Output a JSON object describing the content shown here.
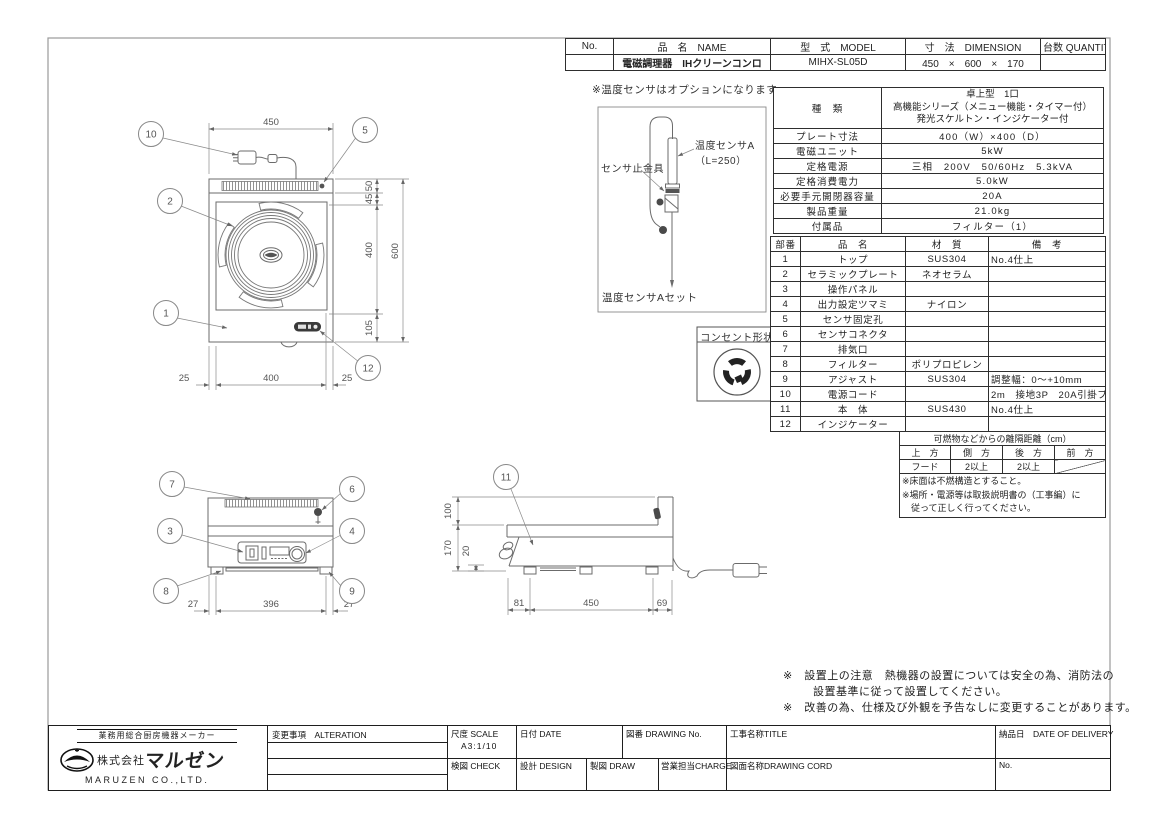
{
  "colors": {
    "line": "#6b6b6b",
    "dim_text": "#555555",
    "table_border": "#2e2e2e",
    "fill_dark": "#3a3a3a"
  },
  "top_table": {
    "headers": {
      "no": "No.",
      "name": "品　名　NAME",
      "model": "型　式　MODEL",
      "dimension": "寸　法　DIMENSION",
      "quantity": "台数 QUANTITY"
    },
    "row": {
      "no": "",
      "name": "電磁調理器　IHクリーンコンロ",
      "model": "MIHX-SL05D",
      "dimension": "450　×　600　×　170",
      "quantity": ""
    }
  },
  "sensor": {
    "note": "※温度センサはオプションになります。",
    "label_a": "温度センサA",
    "label_a_len": "（L=250）",
    "label_clamp": "センサ止金具",
    "caption": "温度センサAセット"
  },
  "outlet": {
    "title": "コンセント形状"
  },
  "spec_table": {
    "kind": {
      "label": "種　類",
      "lines": [
        "卓上型　1口",
        "高機能シリーズ（メニュー機能・タイマー付）",
        "発光スケルトン・インジケーター付"
      ]
    },
    "rows": [
      {
        "label": "プレート寸法",
        "value": "400（W）×400（D）"
      },
      {
        "label": "電磁ユニット",
        "value": "5kW"
      },
      {
        "label": "定格電源",
        "value": "三相　200V　50/60Hz　5.3kVA"
      },
      {
        "label": "定格消費電力",
        "value": "5.0kW"
      },
      {
        "label": "必要手元開閉器容量",
        "value": "20A"
      },
      {
        "label": "製品重量",
        "value": "21.0kg"
      },
      {
        "label": "付属品",
        "value": "フィルター（1）"
      }
    ]
  },
  "parts_table": {
    "headers": [
      "部番",
      "品　名",
      "材　質",
      "備　考"
    ],
    "rows": [
      {
        "no": "1",
        "name": "トップ",
        "material": "SUS304",
        "note": "No.4仕上"
      },
      {
        "no": "2",
        "name": "セラミックプレート",
        "material": "ネオセラム",
        "note": ""
      },
      {
        "no": "3",
        "name": "操作パネル",
        "material": "",
        "note": ""
      },
      {
        "no": "4",
        "name": "出力設定ツマミ",
        "material": "ナイロン",
        "note": ""
      },
      {
        "no": "5",
        "name": "センサ固定孔",
        "material": "",
        "note": ""
      },
      {
        "no": "6",
        "name": "センサコネクタ",
        "material": "",
        "note": ""
      },
      {
        "no": "7",
        "name": "排気口",
        "material": "",
        "note": ""
      },
      {
        "no": "8",
        "name": "フィルター",
        "material": "ポリプロピレン",
        "note": ""
      },
      {
        "no": "9",
        "name": "アジャスト",
        "material": "SUS304",
        "note": "調整幅：0～+10mm"
      },
      {
        "no": "10",
        "name": "電源コード",
        "material": "",
        "note": "2m　接地3P　20A引掛プラグ付"
      },
      {
        "no": "11",
        "name": "本　体",
        "material": "SUS430",
        "note": "No.4仕上"
      },
      {
        "no": "12",
        "name": "インジケーター",
        "material": "",
        "note": ""
      }
    ]
  },
  "clearance": {
    "title": "可燃物などからの離隔距離（cm）",
    "headers": [
      "上　方",
      "側　方",
      "後　方",
      "前　方"
    ],
    "values": [
      "フード",
      "2以上",
      "2以上",
      ""
    ],
    "notes": [
      "※床面は不燃構造とすること。",
      "※場所・電源等は取扱説明書の（工事編）に",
      "　従って正しく行ってください。"
    ]
  },
  "notes": {
    "l1": "※　設置上の注意　熱機器の設置については安全の為、消防法の",
    "l2": "設置基準に従って設置してください。",
    "l3": "※　改善の為、仕様及び外観を予告なしに変更することがあります。"
  },
  "plan": {
    "b10": "10",
    "b5": "5",
    "b2": "2",
    "b1": "1",
    "b12": "12",
    "dim_top": "450",
    "dim_50": "50",
    "dim_45": "45",
    "dim_400": "400",
    "dim_600": "600",
    "dim_105": "105",
    "dim_b25l": "25",
    "dim_b400": "400",
    "dim_b25r": "25"
  },
  "front": {
    "b7": "7",
    "b6": "6",
    "b3": "3",
    "b4": "4",
    "b8": "8",
    "b9": "9",
    "d27l": "27",
    "d396": "396",
    "d27r": "27"
  },
  "side": {
    "b11": "11",
    "d100": "100",
    "d170": "170",
    "d20": "20",
    "d81": "81",
    "d450": "450",
    "d69": "69"
  },
  "title_block": {
    "alteration": "変更事項　ALTERATION",
    "scale_label": "尺度 SCALE",
    "scale_value": "A3:1/10",
    "date_label": "日付 DATE",
    "drawing_no_label": "図番 DRAWING  No.",
    "title_label": "工事名称TITLE",
    "delivery_label": "納品日　DATE OF DELIVERY",
    "check_label": "検図 CHECK",
    "design_label": "設計 DESIGN",
    "draw_label": "製図 DRAW",
    "charge_label": "営業担当CHARGE",
    "drawing_cord_label": "図面名称DRAWING CORD",
    "no_label": "No.",
    "company_tagline": "業務用総合厨房機器メーカー",
    "company_prefix": "株式会社",
    "company_name": "マルゼン",
    "company_en": "MARUZEN CO.,LTD."
  }
}
